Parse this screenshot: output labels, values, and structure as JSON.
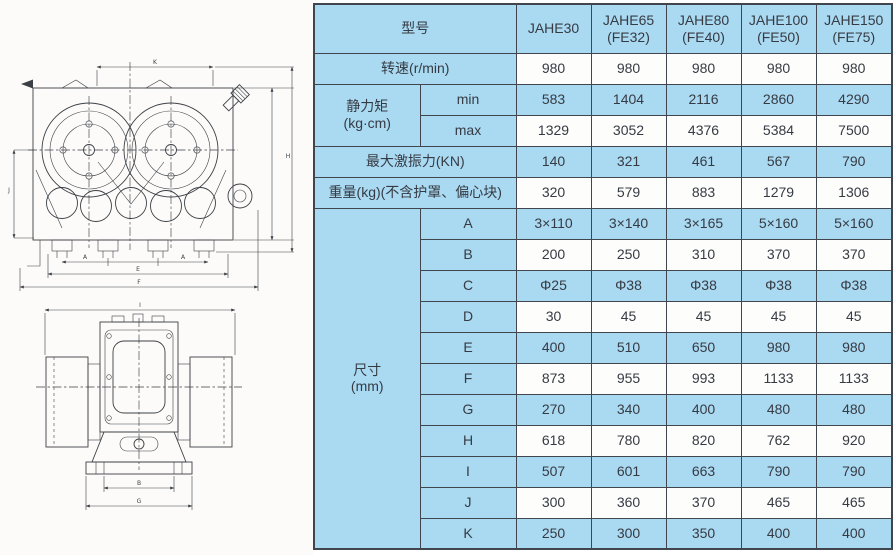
{
  "table": {
    "model_row": {
      "label": "型号",
      "models": [
        "JAHE30",
        "JAHE65\n(FE32)",
        "JAHE80\n(FE40)",
        "JAHE100\n(FE50)",
        "JAHE150\n(FE75)"
      ]
    },
    "rows": [
      {
        "label": "转速(r/min)",
        "span": 2,
        "tint": "white",
        "values": [
          "980",
          "980",
          "980",
          "980",
          "980"
        ]
      },
      {
        "group": "静力矩\n(kg·cm)",
        "group_rows": 2,
        "label": "min",
        "tint": "blue",
        "values": [
          "583",
          "1404",
          "2116",
          "2860",
          "4290"
        ]
      },
      {
        "label": "max",
        "tint": "white",
        "values": [
          "1329",
          "3052",
          "4376",
          "5384",
          "7500"
        ]
      },
      {
        "label": "最大激振力(KN)",
        "span": 2,
        "tint": "blue",
        "values": [
          "140",
          "321",
          "461",
          "567",
          "790"
        ]
      },
      {
        "label": "重量(kg)(不含护罩、偏心块)",
        "span": 2,
        "tint": "white",
        "values": [
          "320",
          "579",
          "883",
          "1279",
          "1306"
        ]
      },
      {
        "group": "尺寸\n(mm)",
        "group_rows": 11,
        "label": "A",
        "tint": "blue",
        "values": [
          "3×110",
          "3×140",
          "3×165",
          "5×160",
          "5×160"
        ]
      },
      {
        "label": "B",
        "tint": "white",
        "values": [
          "200",
          "250",
          "310",
          "370",
          "370"
        ]
      },
      {
        "label": "C",
        "tint": "blue",
        "values": [
          "Φ25",
          "Φ38",
          "Φ38",
          "Φ38",
          "Φ38"
        ]
      },
      {
        "label": "D",
        "tint": "white",
        "values": [
          "30",
          "45",
          "45",
          "45",
          "45"
        ]
      },
      {
        "label": "E",
        "tint": "blue",
        "values": [
          "400",
          "510",
          "650",
          "980",
          "980"
        ]
      },
      {
        "label": "F",
        "tint": "white",
        "values": [
          "873",
          "955",
          "993",
          "1133",
          "1133"
        ]
      },
      {
        "label": "G",
        "tint": "blue",
        "values": [
          "270",
          "340",
          "400",
          "480",
          "480"
        ]
      },
      {
        "label": "H",
        "tint": "white",
        "values": [
          "618",
          "780",
          "820",
          "762",
          "920"
        ]
      },
      {
        "label": "I",
        "tint": "blue",
        "values": [
          "507",
          "601",
          "663",
          "790",
          "790"
        ]
      },
      {
        "label": "J",
        "tint": "white",
        "values": [
          "300",
          "360",
          "370",
          "465",
          "465"
        ]
      },
      {
        "label": "K",
        "tint": "blue",
        "values": [
          "250",
          "300",
          "350",
          "400",
          "400"
        ]
      }
    ]
  },
  "drawing": {
    "dims": {
      "front_top": "K",
      "front_bottom_a1": "A",
      "front_bottom_a2": "A",
      "front_bottom_e": "E",
      "front_bottom_f": "F",
      "front_left": "J",
      "front_right": "H",
      "side_top": "I",
      "side_bottom_inner": "B",
      "side_bottom_outer": "G"
    }
  },
  "colors": {
    "cell_blue": "#aad9f2",
    "cell_white": "#fdfdfc",
    "border": "#41464e",
    "text": "#363b43",
    "line": "#3c4046"
  }
}
